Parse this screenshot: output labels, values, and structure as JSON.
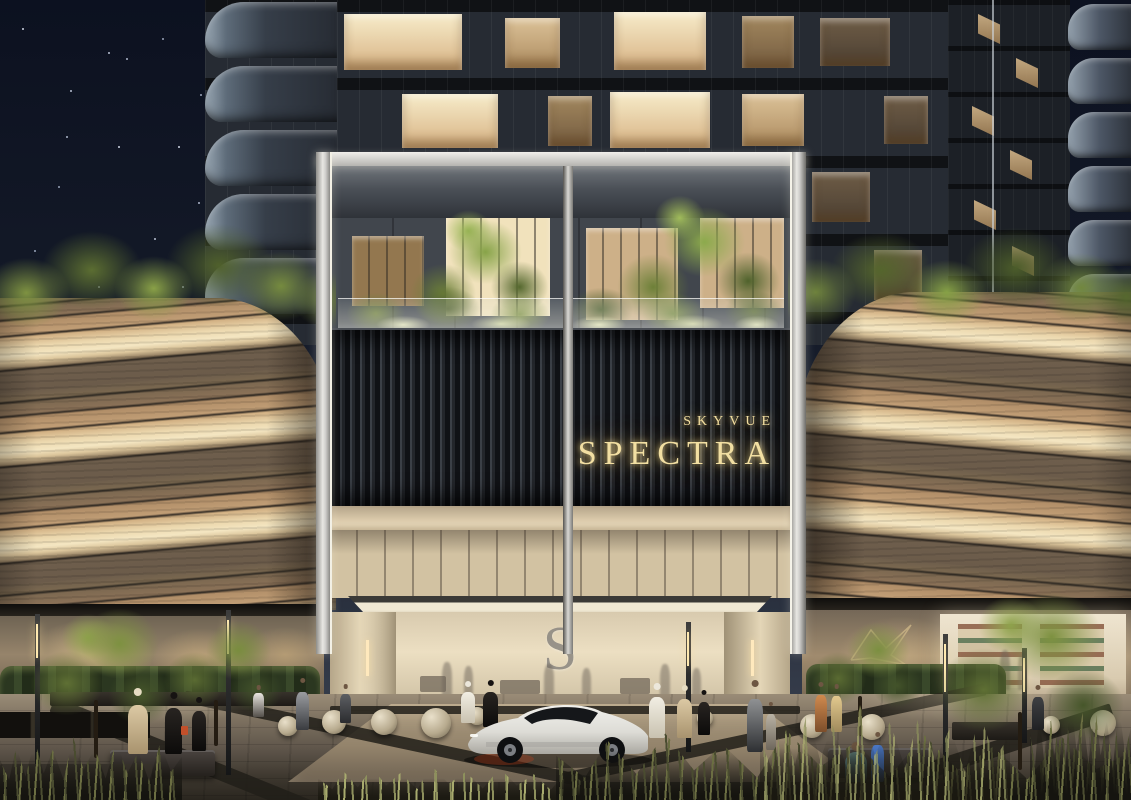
{
  "scene": {
    "title": "SkyVue Spectra residential tower entrance, night architectural rendering",
    "setting": "night"
  },
  "signage": {
    "brand_line": "SKYVUE",
    "name_line": "SPECTRA",
    "lobby_monogram": "S"
  },
  "colors": {
    "gold": "#f2dfa2",
    "skyTop": "#0d1220",
    "towerDark": "#262b33",
    "slatDark": "#101216",
    "frameSilver": "#e8e7e3",
    "bandTan": "#c09d75",
    "bandCream": "#f4e6c2",
    "bandBrown": "#6e5e4c",
    "lobbyWarm": "#e7dabd",
    "canopyGlow": "#f1e9d4",
    "monogram": "#8d8982",
    "stone": "#b7aa8e",
    "carBody": "#e8e7e3"
  }
}
